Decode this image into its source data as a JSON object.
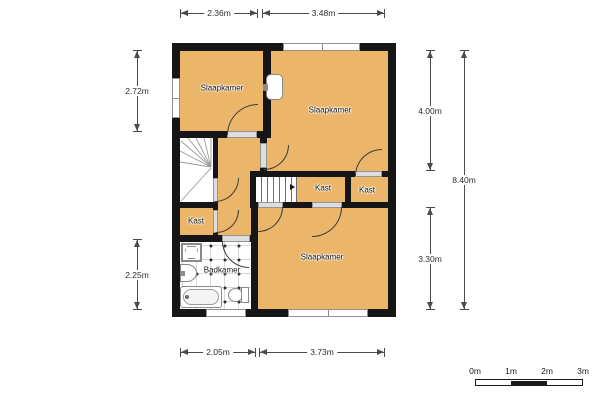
{
  "plan": {
    "title": "floor-plan",
    "rooms": [
      {
        "id": "bedroom-top-left",
        "label": "Slaapkamer"
      },
      {
        "id": "bedroom-top-right",
        "label": "Slaapkamer"
      },
      {
        "id": "bedroom-bottom",
        "label": "Slaapkamer"
      },
      {
        "id": "closet-left",
        "label": "Kast"
      },
      {
        "id": "closet-middle",
        "label": "Kast"
      },
      {
        "id": "closet-right",
        "label": "Kast"
      },
      {
        "id": "bathroom",
        "label": "Badkamer"
      }
    ],
    "fixtures": [
      "shower",
      "washbasin",
      "bathtub",
      "toilet",
      "bedroom-sink",
      "winder-staircase",
      "straight-staircase"
    ],
    "dimensions": {
      "top": [
        {
          "label": "2.36m"
        },
        {
          "label": "3.48m"
        }
      ],
      "bottom": [
        {
          "label": "2.05m"
        },
        {
          "label": "3.73m"
        }
      ],
      "left": [
        {
          "label": "2.72m"
        },
        {
          "label": "2.25m"
        }
      ],
      "right": [
        {
          "label": "4.00m"
        },
        {
          "label": "3.30m"
        },
        {
          "label": "8.40m"
        }
      ]
    },
    "scale_bar": {
      "labels": [
        "0m",
        "1m",
        "2m",
        "3m"
      ]
    },
    "colors": {
      "room_fill": "#EBB56A",
      "wall": "#161616",
      "background": "#FFFFFF"
    }
  }
}
